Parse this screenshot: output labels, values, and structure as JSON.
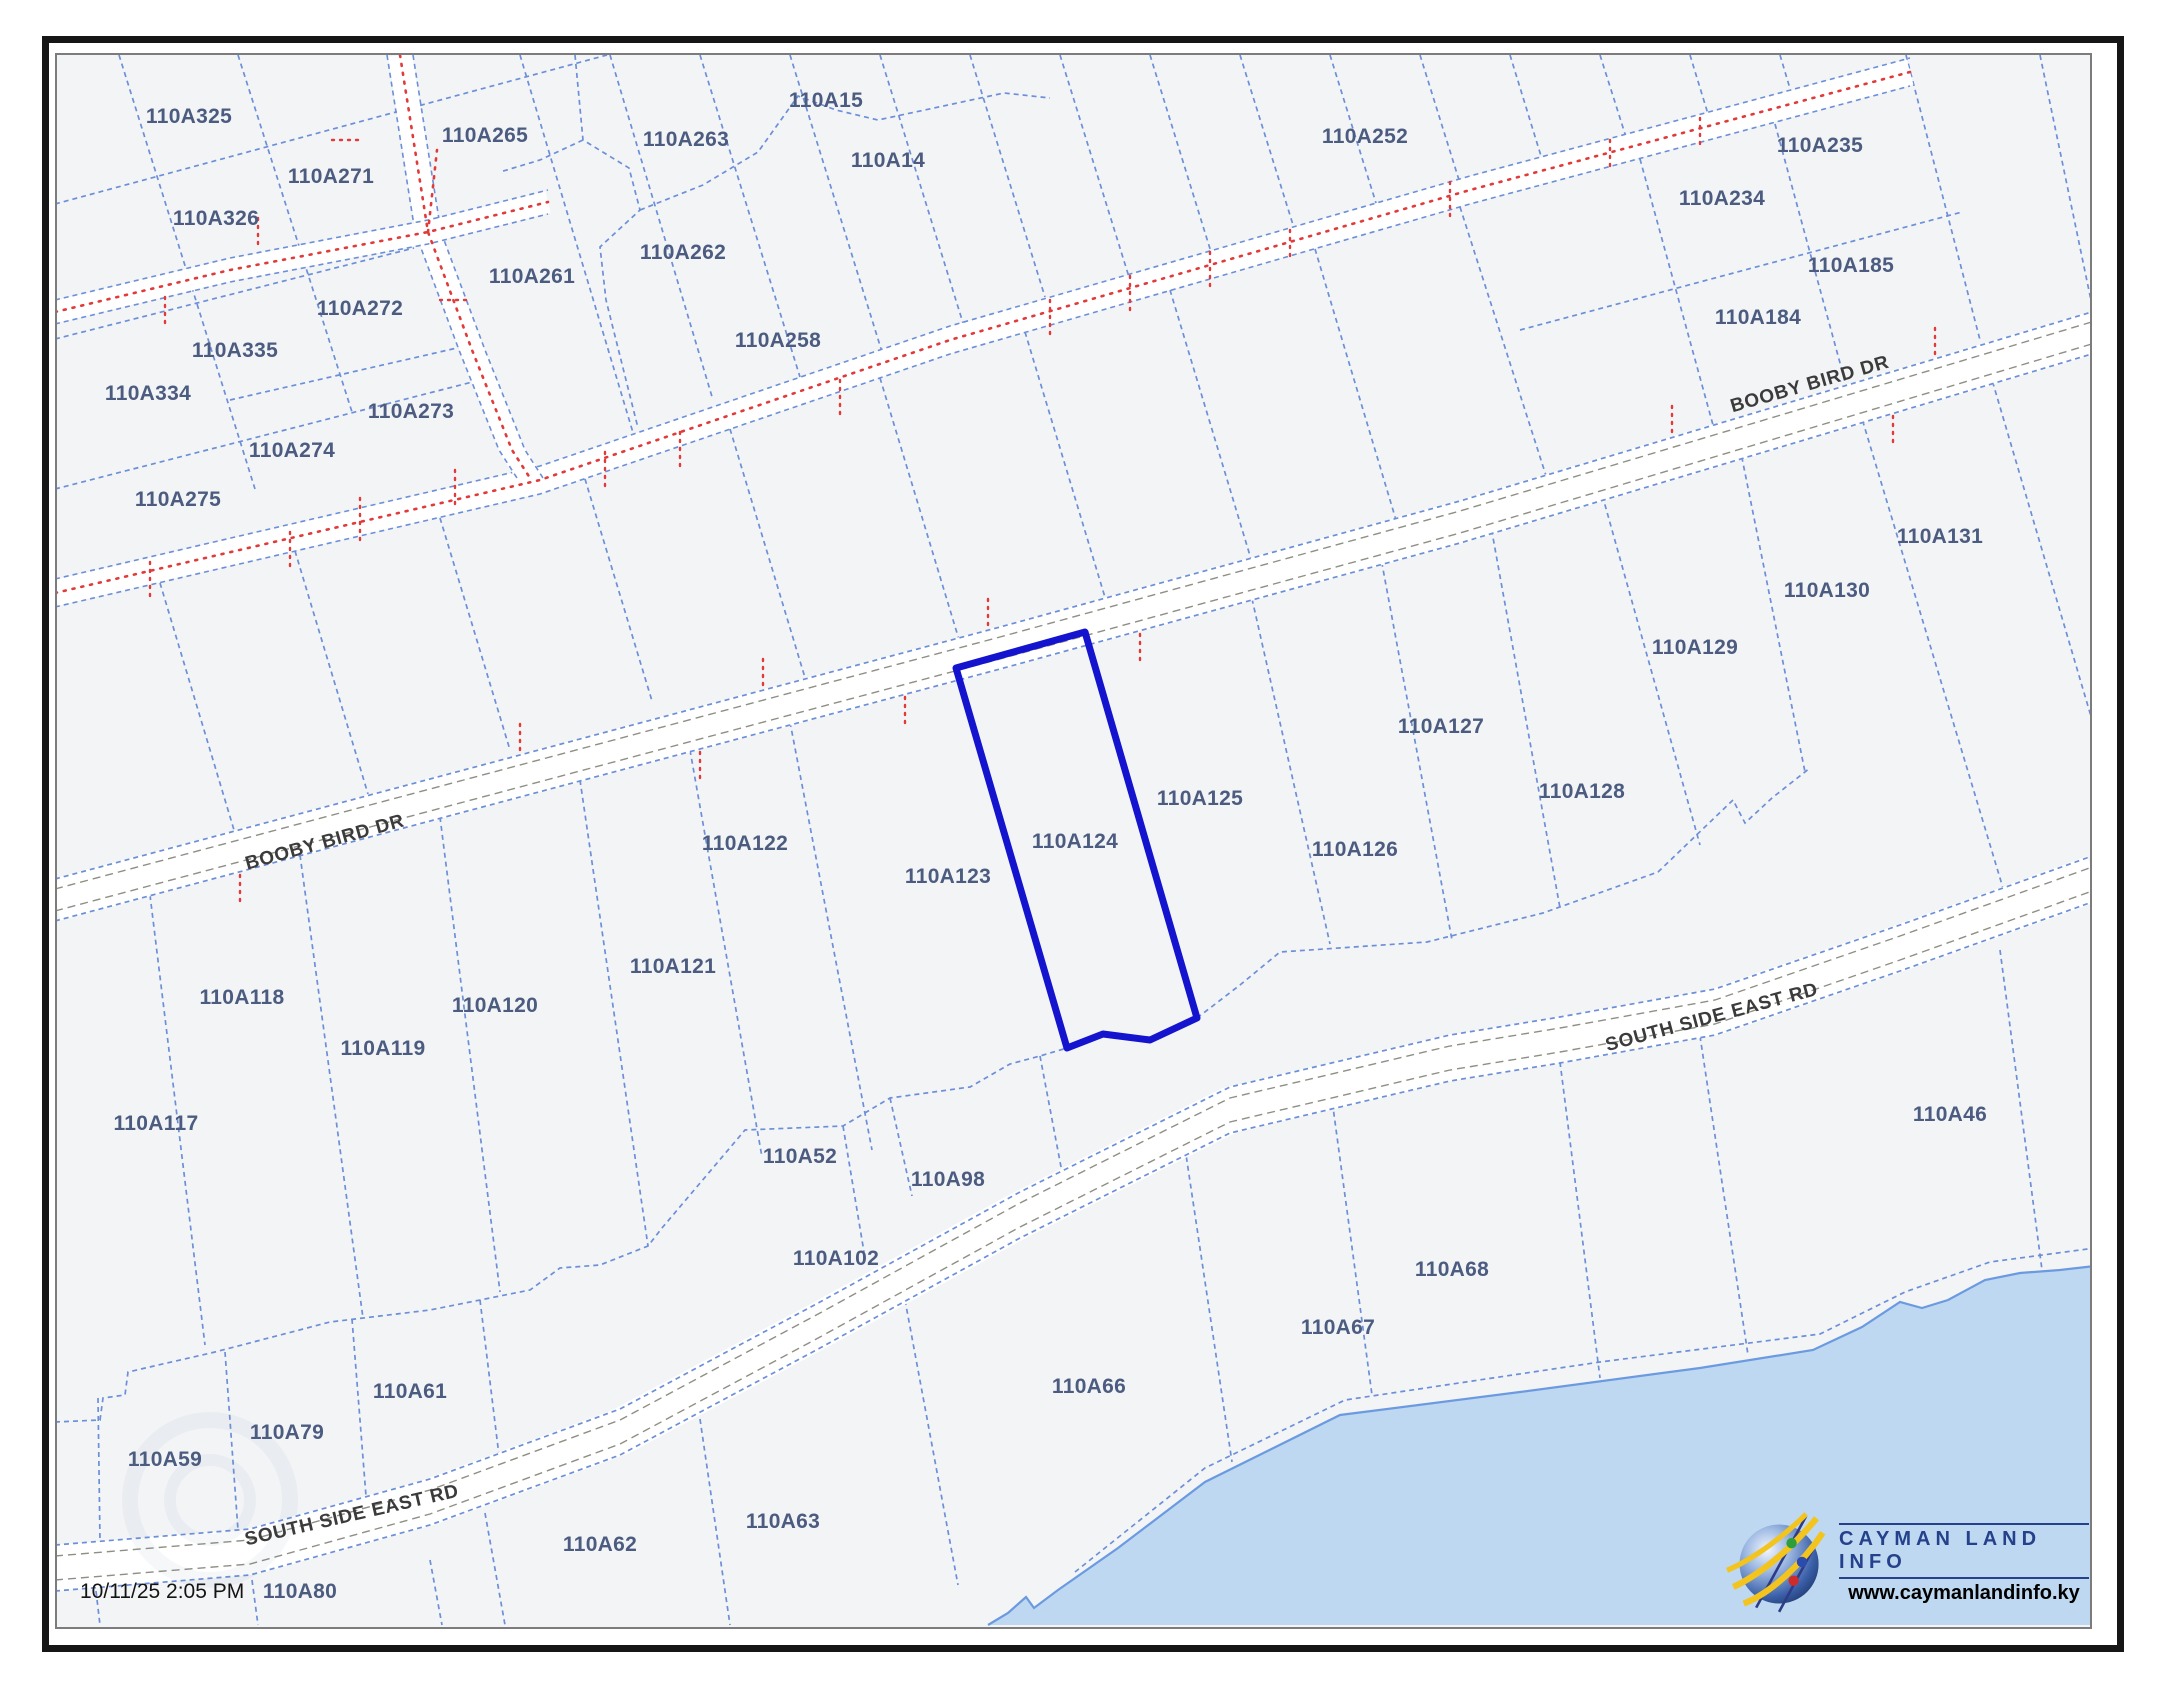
{
  "app": {
    "timestamp": "10/11/25 2:05 PM"
  },
  "map": {
    "highlighted_parcel": "110A124",
    "colors": {
      "highlight": "#1414cf",
      "parcel_line": "#6c8fd8",
      "sea": "#bdd8f0",
      "shoreline": "#6c9ae0",
      "red_dots": "#e03a3a",
      "label_text": "#4c5c80",
      "background": "#f3f4f6"
    },
    "road_labels": [
      {
        "text": "BOOBY BIRD DR",
        "x": 325,
        "y": 843,
        "angle": -15.5
      },
      {
        "text": "BOOBY BIRD DR",
        "x": 1810,
        "y": 385,
        "angle": -16
      },
      {
        "text": "SOUTH SIDE EAST RD",
        "x": 352,
        "y": 1516,
        "angle": -13
      },
      {
        "text": "SOUTH SIDE EAST RD",
        "x": 1712,
        "y": 1018,
        "angle": -15
      }
    ],
    "parcels": [
      {
        "id": "110A325",
        "x": 189,
        "y": 117
      },
      {
        "id": "110A265",
        "x": 485,
        "y": 136
      },
      {
        "id": "110A263",
        "x": 686,
        "y": 140
      },
      {
        "id": "110A15",
        "x": 826,
        "y": 101
      },
      {
        "id": "110A14",
        "x": 888,
        "y": 161
      },
      {
        "id": "110A271",
        "x": 331,
        "y": 177
      },
      {
        "id": "110A326",
        "x": 216,
        "y": 219
      },
      {
        "id": "110A262",
        "x": 683,
        "y": 253
      },
      {
        "id": "110A261",
        "x": 532,
        "y": 277
      },
      {
        "id": "110A272",
        "x": 360,
        "y": 309
      },
      {
        "id": "110A335",
        "x": 235,
        "y": 351
      },
      {
        "id": "110A334",
        "x": 148,
        "y": 394
      },
      {
        "id": "110A273",
        "x": 411,
        "y": 412
      },
      {
        "id": "110A274",
        "x": 292,
        "y": 451
      },
      {
        "id": "110A275",
        "x": 178,
        "y": 500
      },
      {
        "id": "110A258",
        "x": 778,
        "y": 341
      },
      {
        "id": "110A252",
        "x": 1365,
        "y": 137
      },
      {
        "id": "110A235",
        "x": 1820,
        "y": 146
      },
      {
        "id": "110A234",
        "x": 1722,
        "y": 199
      },
      {
        "id": "110A185",
        "x": 1851,
        "y": 266
      },
      {
        "id": "110A184",
        "x": 1758,
        "y": 318
      },
      {
        "id": "110A131",
        "x": 1940,
        "y": 537
      },
      {
        "id": "110A130",
        "x": 1827,
        "y": 591
      },
      {
        "id": "110A129",
        "x": 1695,
        "y": 648
      },
      {
        "id": "110A127",
        "x": 1441,
        "y": 727
      },
      {
        "id": "110A128",
        "x": 1582,
        "y": 792
      },
      {
        "id": "110A126",
        "x": 1355,
        "y": 850
      },
      {
        "id": "110A125",
        "x": 1200,
        "y": 799
      },
      {
        "id": "110A124",
        "x": 1075,
        "y": 842,
        "highlighted": true
      },
      {
        "id": "110A123",
        "x": 948,
        "y": 877
      },
      {
        "id": "110A122",
        "x": 745,
        "y": 844
      },
      {
        "id": "110A121",
        "x": 673,
        "y": 967
      },
      {
        "id": "110A120",
        "x": 495,
        "y": 1006
      },
      {
        "id": "110A119",
        "x": 383,
        "y": 1049
      },
      {
        "id": "110A118",
        "x": 242,
        "y": 998
      },
      {
        "id": "110A117",
        "x": 156,
        "y": 1124
      },
      {
        "id": "110A52",
        "x": 800,
        "y": 1157
      },
      {
        "id": "110A98",
        "x": 948,
        "y": 1180
      },
      {
        "id": "110A102",
        "x": 836,
        "y": 1259
      },
      {
        "id": "110A46",
        "x": 1950,
        "y": 1115
      },
      {
        "id": "110A68",
        "x": 1452,
        "y": 1270
      },
      {
        "id": "110A67",
        "x": 1338,
        "y": 1328
      },
      {
        "id": "110A66",
        "x": 1089,
        "y": 1387
      },
      {
        "id": "110A61",
        "x": 410,
        "y": 1392
      },
      {
        "id": "110A79",
        "x": 287,
        "y": 1433
      },
      {
        "id": "110A59",
        "x": 165,
        "y": 1460
      },
      {
        "id": "110A63",
        "x": 783,
        "y": 1522
      },
      {
        "id": "110A62",
        "x": 600,
        "y": 1545
      },
      {
        "id": "110A80",
        "x": 300,
        "y": 1592
      }
    ]
  },
  "logo": {
    "title": "CAYMAN LAND INFO",
    "website": "www.caymanlandinfo.ky"
  }
}
